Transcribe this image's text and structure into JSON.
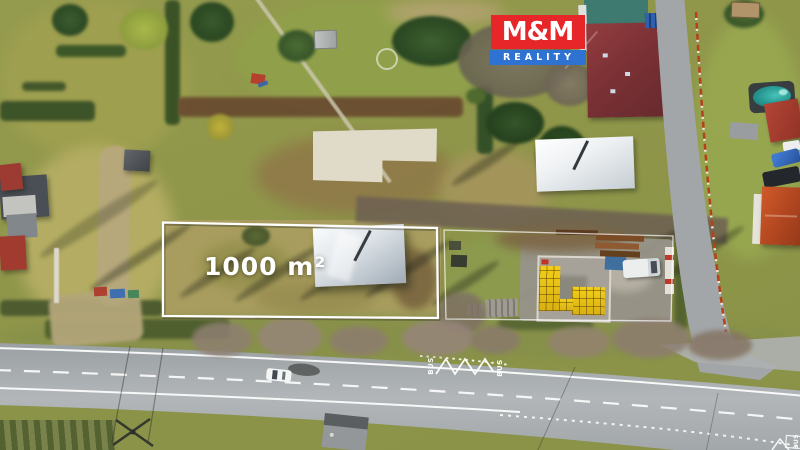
{
  "plot": {
    "area_label": "1000 m²"
  },
  "branding": {
    "logo_top": "M&M",
    "logo_bottom": "REALITY"
  },
  "road_markings": {
    "bus_left_start": "BUS",
    "bus_left_end": "BUS",
    "bus_corner": "BUS"
  },
  "colors": {
    "logo_red": "#e62629",
    "logo_blue": "#2e72d2",
    "outline_white": "#ffffff",
    "grass_base": "#93994d",
    "plot_grass": "#a89d5e",
    "road_asphalt": "#a6aaad",
    "roof_dark_red": "#7b3135",
    "roof_orange": "#b04620",
    "pool_water": "#2a9e97",
    "crate_yellow": "#e4bd15",
    "fence_red": "#b5401c"
  }
}
